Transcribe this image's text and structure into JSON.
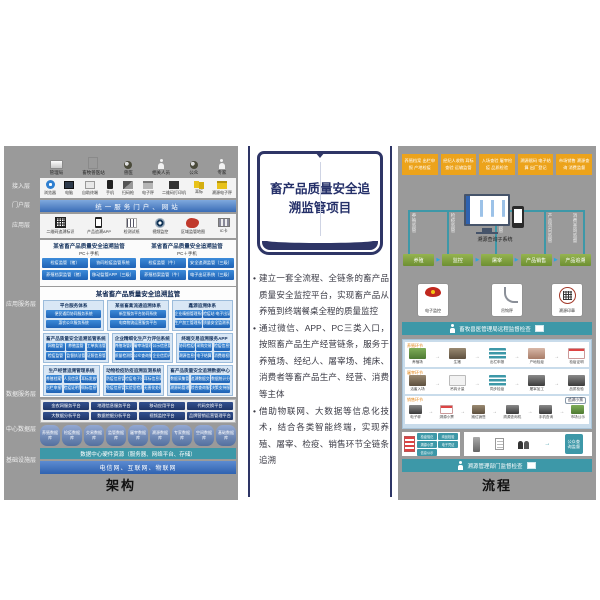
{
  "middle": {
    "title": "畜产品质量安全追溯监管项目",
    "bullet_dot": "•",
    "bullets": [
      "建立一套全流程、全链条的畜产品质量安全监控平台，实现畜产品从养殖到终端餐桌全程的质量监控",
      "通过微信、APP、PC三类入口，按照畜产品生产经营链条，服务于养殖场、经纪人、屠宰场、摊床、消费者等畜产品生产、经营、消费等主体",
      "借助物联网、大数据等信息化技术，结合各类智能终端，实现养殖、屠宰、检疫、销售环节全链条追溯"
    ]
  },
  "left": {
    "caption": "架构",
    "layers": [
      "接入层",
      "门户层",
      "应用层",
      "应用服务层",
      "数据服务层",
      "中心数据层",
      "基础设施层"
    ],
    "actors": [
      "管理局",
      "畜牧兽医站",
      "兽医",
      "相关人员",
      "公众",
      "专家"
    ],
    "access_icons": [
      "浏览器",
      "电脑",
      "自助终端",
      "手机",
      "扫码枪",
      "电子秤",
      "二维码打印机",
      "耳标",
      "溯源电子秤"
    ],
    "portal_bar": "统一服务门户、网站",
    "terminal_icons": [
      "二维码追溯标识",
      "产品追溯APP",
      "检测试纸",
      "视频监控",
      "区域监管地图",
      "IC卡"
    ],
    "dual_groups": [
      {
        "title": "某省畜产品质量安全追溯监管",
        "tag": "PC＋手机",
        "buttons": [
          "检疫监管（猪）",
          "协同检疫监管系统",
          "养殖档案监管（猪）",
          "移动监管APP（三级）"
        ]
      },
      {
        "title": "某省畜产品质量安全追溯监管",
        "tag": "PC＋手机",
        "buttons": [
          "检疫监管（牛）",
          "安全追溯监管（三级）",
          "养殖档案监管（牛）",
          "电子出证系统（三级）"
        ]
      }
    ],
    "platform": {
      "title": "某省畜产品质量安全追溯监管",
      "svc_groups": [
        {
          "title": "平台服务体系",
          "buttons": [
            "便民通用协同服务系统",
            "惠农公众服务系统"
          ]
        },
        {
          "title": "某省畜禽流通追溯体系",
          "buttons": [
            "新型服务平台协同系统",
            "电商物流运营服务平台"
          ]
        },
        {
          "title": "鑫源追溯体系",
          "buttons": [
            "企业精细管理系统（禽）",
            "检疫站·电子出证系统",
            "生产加工管理系统",
            "质量安全监测系统"
          ]
        }
      ],
      "app_groups": [
        {
          "title": "畜产品质量安全追溯监管系统",
          "buttons": [
            "网格监管",
            "养殖监管",
            "工单执法管理",
            "检疫监管",
            "监督执法管理",
            "证照信息管理"
          ]
        },
        {
          "title": "企业精细化生产力评估系统",
          "buttons": [
            "养殖场管理",
            "屠宰场管理",
            "公示信息管理",
            "质量检测管理",
            "公众查询服务",
            "企业信用评价"
          ]
        },
        {
          "title": "终端交易追溯服务APP",
          "buttons": [
            "协同检疫申报",
            "采购交易管理",
            "检疫信息查询",
            "溯源信息查询",
            "电子结算管理",
            "消费维权服务"
          ]
        }
      ],
      "biz_groups": [
        {
          "title": "生产经营追溯管理系统",
          "buttons": [
            "养殖档案管理",
            "人员信息管理",
            "耳标发放管理",
            "出栏申报管理",
            "检疫证明管理",
            "佩标信息管理"
          ]
        },
        {
          "title": "动物检疫防疫追溯监测系统",
          "buttons": [
            "防疫信息管理",
            "检疫电子出证",
            "耳标信息采集",
            "免疫信息管理",
            "实验室检测",
            "无害化处理"
          ]
        },
        {
          "title": "畜产品质量安全追溯数据中心",
          "buttons": [
            "数据采集管理",
            "追溯数据交换",
            "数据统计分析",
            "溯源码管理",
            "综合查询服务",
            "决策支持服务"
          ]
        }
      ]
    },
    "support_platforms": [
      "金农网服务平台",
      "地理信息服务平台",
      "移动应用平台",
      "代码交换平台",
      "大数据分析平台",
      "数据挖掘分析平台",
      "视频监控平台",
      "品牌营销运营管理平台"
    ],
    "databases": [
      "养殖数据库",
      "检疫数据库",
      "交易数据库",
      "监管数据库",
      "屠宰数据库",
      "溯源数据库",
      "专家数据库",
      "空间数据库",
      "基础数据库"
    ],
    "hardware_bar": "数据中心硬件资源（服务器、网络平台、存储）",
    "network_bar": "电信网、互联网、物联网"
  },
  "right": {
    "caption": "流程",
    "stages": [
      "养殖档案 出栏申报 产地检疫",
      "经纪人收购 耳标查验 运输监管",
      "入场查验 屠宰检疫 品质检验",
      "溯源赋码 电子结算 出厂登记",
      "市场销售 溯源查询 消费监督"
    ],
    "system_label": "溯源查询子系统",
    "chain_labels": [
      "养殖监管",
      "检疫监管",
      "屠宰监管",
      "产品流向监管",
      "消费查询监督"
    ],
    "process_buttons": [
      "养殖",
      "监控",
      "屠宰",
      "产品销售",
      "产品追溯"
    ],
    "device_cards": [
      "电子监控",
      "吊钩秤",
      "溯源印章"
    ],
    "bar_top": "畜牧兽医管理局远程监督检查",
    "bar_bottom": "溯源管理部门监督检查",
    "flow_rows": [
      {
        "label": "养殖环节",
        "steps": [
          {
            "label": "养殖场",
            "kind": "farm"
          },
          {
            "label": "生猪",
            "kind": "animal"
          },
          {
            "label": "出栏申报",
            "kind": "stack"
          },
          {
            "label": "产地检疫",
            "kind": "vet"
          },
          {
            "label": "检疫证明",
            "kind": "doc"
          }
        ]
      },
      {
        "label": "屠宰环节",
        "steps": [
          {
            "label": "活畜入场",
            "kind": "animal"
          },
          {
            "label": "吊钩计量",
            "kind": "hook"
          },
          {
            "label": "同步检疫",
            "kind": "stack"
          },
          {
            "label": "屠宰加工",
            "kind": "dark"
          },
          {
            "label": "品质检验",
            "kind": "dark"
          }
        ]
      },
      {
        "label": "销售环节",
        "steps": [
          {
            "label": "电子秤",
            "kind": "dark"
          },
          {
            "label": "溯源小票",
            "kind": "doc"
          },
          {
            "label": "摊位销售",
            "kind": "animal"
          },
          {
            "label": "溯源查询机",
            "kind": "dark"
          },
          {
            "label": "手机查询",
            "kind": "dark"
          },
          {
            "label": "市场公示",
            "kind": "farm"
          }
        ]
      }
    ],
    "receipt_tag": "追溯小票",
    "cert_items": [
      "检疫验讫",
      "肉品检验",
      "溯源小票",
      "电子凭证",
      "信息公示"
    ],
    "public_label": "公众查询监督"
  }
}
